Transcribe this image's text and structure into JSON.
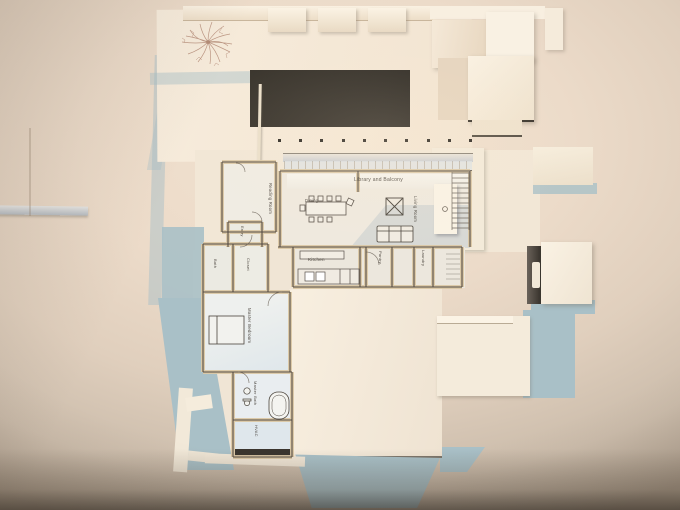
{
  "plan_labels": {
    "library": "Library and Balcony",
    "dining": "Dining",
    "living_room": "Living Room",
    "reading_room": "Reading Room",
    "entry": "Entry",
    "bath": "Bath",
    "closet": "Closet",
    "master_bedroom": "Master Bedroom",
    "master_bath": "Master Bath",
    "hvac": "HVAC",
    "kitchen": "Kitchen",
    "pantry": "Pantry",
    "laundry": "Laundry"
  },
  "palette": {
    "backdrop_warm": "#ecdbc9",
    "model_card_white": "#f6ecdc",
    "cast_shadow_blue": "#a9c0c7",
    "plan_shadow_tint": "#d7e0e7",
    "dark_roof_panel": "#37332c",
    "wall_edge_tan": "#dbc8a5",
    "plan_line": "#554c43",
    "tree_sketch_stroke": "#b48a76"
  }
}
